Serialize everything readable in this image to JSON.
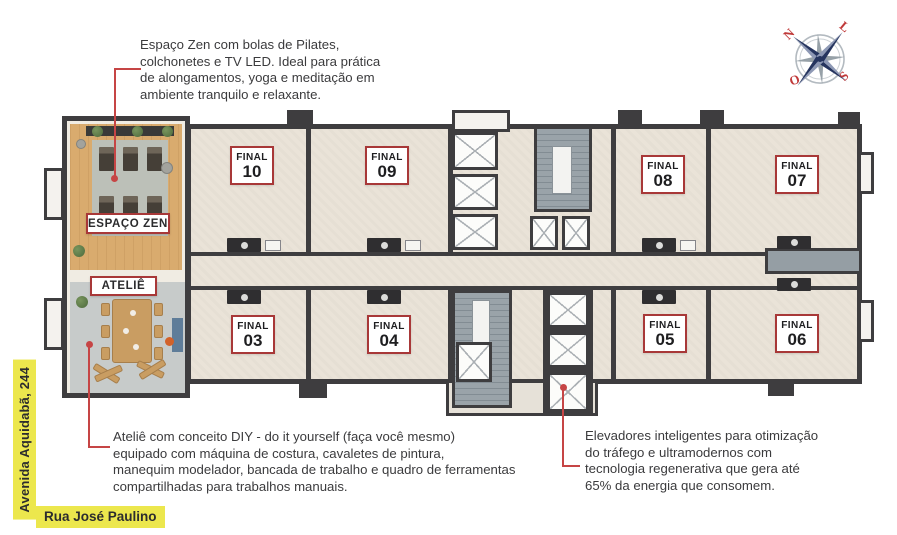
{
  "annotations": {
    "zen": {
      "lines": [
        "Espaço Zen com bolas de Pilates,",
        "colchonetes e TV LED. Ideal para prática",
        "de alongamentos, yoga e meditação em",
        "ambiente tranquilo e relaxante."
      ]
    },
    "atelie": {
      "lines": [
        "Ateliê com conceito DIY - do it yourself (faça você mesmo)",
        "equipado com máquina de costura, cavaletes de pintura,",
        "manequim modelador, bancada de trabalho e quadro de ferramentas",
        "compartilhadas para trabalhos manuais."
      ]
    },
    "elevators": {
      "lines": [
        "Elevadores inteligentes para otimização",
        "do tráfego e ultramodernos com",
        "tecnologia regenerativa que gera até",
        "65% da energia que consomem."
      ]
    }
  },
  "streets": {
    "avenue": "Avenida Aquidabã, 244",
    "street": "Rua José Paulino"
  },
  "rooms": {
    "zen": "ESPAÇO ZEN",
    "atelie": "ATELIÊ"
  },
  "units": [
    {
      "prefix": "FINAL",
      "number": "10"
    },
    {
      "prefix": "FINAL",
      "number": "09"
    },
    {
      "prefix": "FINAL",
      "number": "08"
    },
    {
      "prefix": "FINAL",
      "number": "07"
    },
    {
      "prefix": "FINAL",
      "number": "03"
    },
    {
      "prefix": "FINAL",
      "number": "04"
    },
    {
      "prefix": "FINAL",
      "number": "05"
    },
    {
      "prefix": "FINAL",
      "number": "06"
    }
  ],
  "compass": {
    "north": "N",
    "east": "L",
    "south": "S",
    "west": "O"
  },
  "colors": {
    "label_border_red": "#a83838",
    "leader_red": "#c64545",
    "highlight_yellow": "#ece74d",
    "wall_dark": "#3e3d3f",
    "floor_beige": "#eae3d8",
    "zen_wood": "#d9ab6e",
    "atelie_gray": "#c7cbca",
    "core_gray": "#99a2a8",
    "compass_navy": "#26355f",
    "compass_red": "#c03a3a"
  }
}
